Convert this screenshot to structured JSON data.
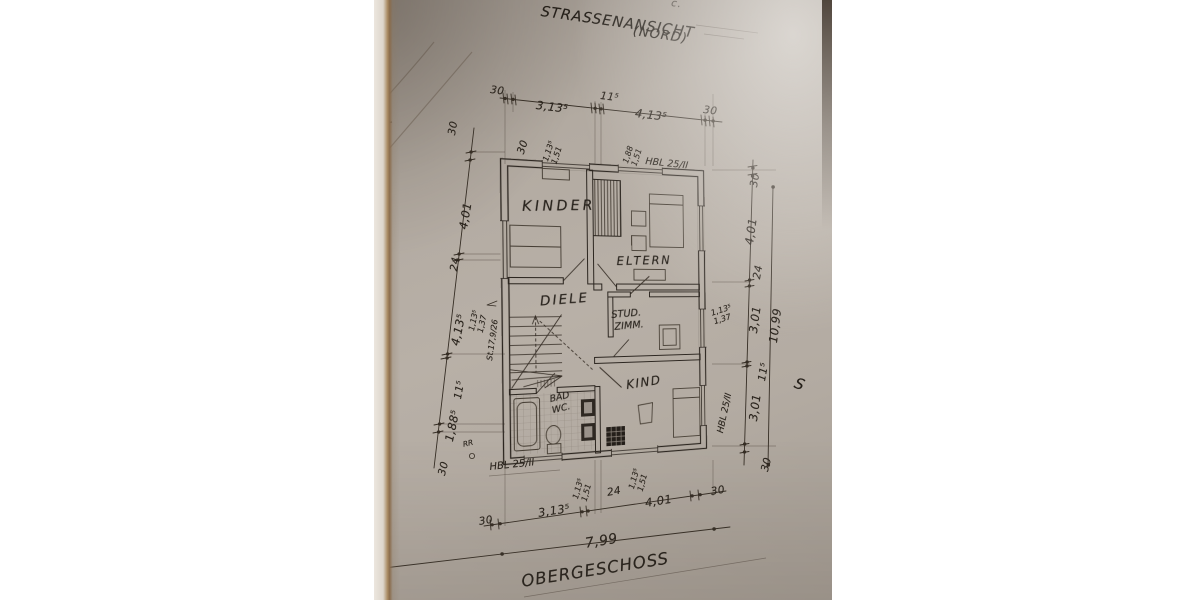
{
  "titles": {
    "street_view": "STRASSENANSICHT",
    "street_view_sub": "(NORD)",
    "floor": "OBERGESCHOSS",
    "edge_letter": "S",
    "edge_mark": "c."
  },
  "rooms": {
    "kinder": "KINDER",
    "eltern": "ELTERN",
    "diele": "DIELE",
    "stud_line1": "STUD.",
    "stud_line2": "ZIMM.",
    "kind": "KIND",
    "bad_line1": "BAD",
    "bad_line2": "WC."
  },
  "materials": {
    "wall_top": "HBL 25/II",
    "wall_bottom": "HBL 25/II",
    "wall_right": "HBL 25/II",
    "rain_pipe": "RR"
  },
  "dims": {
    "top": [
      "30",
      "3,13⁵",
      "11⁵",
      "4,13⁵",
      "30"
    ],
    "bottom": [
      "30",
      "3,13⁵",
      "24",
      "4,01",
      "30"
    ],
    "left": [
      "30",
      "4,01",
      "24",
      "4,13⁵",
      "11⁵",
      "1,88⁵",
      "30"
    ],
    "left_extra": "30",
    "right": [
      "30",
      "4,01",
      "24",
      "3,01",
      "11⁵",
      "3,01",
      "30"
    ],
    "total_width": "7,99",
    "total_height": "10,99",
    "win_top_1": "1,13⁵\n1,51",
    "win_top_2": "1,88\n1,51",
    "win_bottom_1": "1,13⁵\n1,51",
    "win_bottom_2": "1,13⁵\n1,51",
    "win_left": "1,13⁵\n1,37",
    "win_right": "1,13⁵\n1,37",
    "stair_note": "St.17,9/26"
  }
}
